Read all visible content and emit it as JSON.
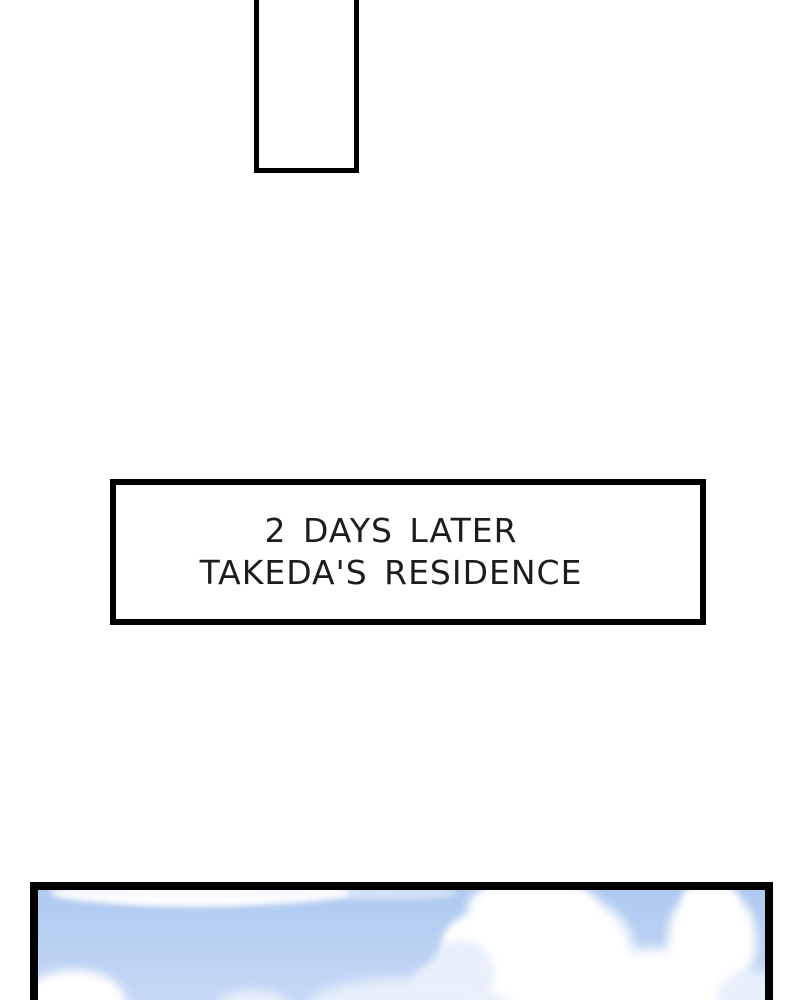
{
  "caption": {
    "line1": "2 DAYS LATER",
    "line2": "TAKEDA'S RESIDENCE"
  },
  "colors": {
    "panel_border": "#000000",
    "page_bg": "#ffffff",
    "sky_top": "#aec9f0",
    "sky_bottom": "#c9daf6",
    "cloud_white": "#ffffff",
    "cloud_shadow": "#e7effb",
    "text_color": "#1d1d1d"
  }
}
